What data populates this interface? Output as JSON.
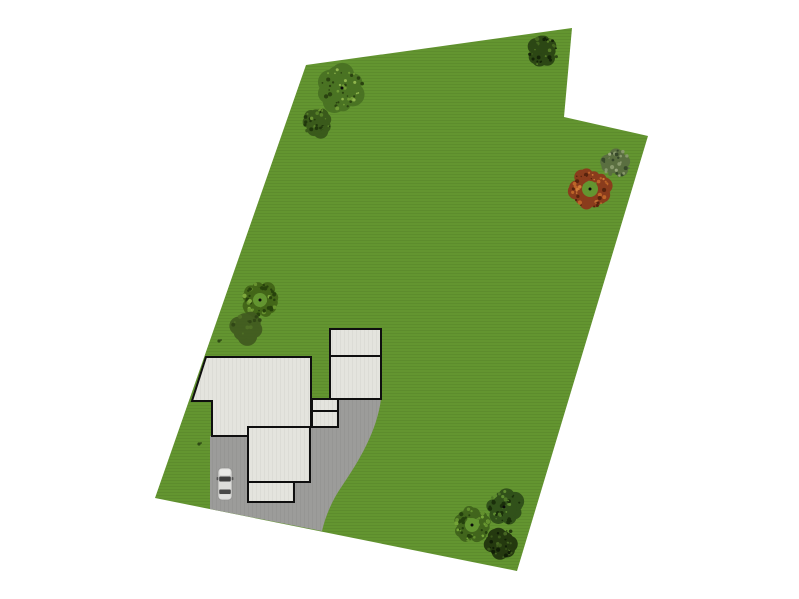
{
  "page": {
    "background": "#ffffff"
  },
  "scene": {
    "canvas": {
      "width": 799,
      "height": 599
    },
    "lot": {
      "name": "property-lot",
      "points": [
        [
          306,
          65
        ],
        [
          572,
          28
        ],
        [
          564,
          117
        ],
        [
          648,
          136
        ],
        [
          517,
          571
        ],
        [
          155,
          498
        ]
      ],
      "fill": "#639530",
      "stripe": "#578529"
    },
    "driveway": {
      "name": "driveway",
      "path": "M 210,436 L 311,427 L 312,399 L 381,399 C 377,431 359,461 342,486 C 333,499 326,514 322,531 L 210,509 Z",
      "fill": "#9c9c9a",
      "stripe": "#929290"
    },
    "house": {
      "fill": "#e4e4de",
      "stripe": "#d9d9d3",
      "stroke": "#0f0f0f",
      "stroke_width": 2,
      "shapes": [
        {
          "name": "main-house",
          "type": "polygon",
          "points": [
            [
              206,
              357
            ],
            [
              311,
              357
            ],
            [
              311,
              427
            ],
            [
              248,
              427
            ],
            [
              248,
              436
            ],
            [
              212,
              436
            ],
            [
              212,
              401
            ],
            [
              192,
              401
            ]
          ]
        },
        {
          "name": "rear-wing",
          "type": "rect",
          "x": 248,
          "y": 427,
          "w": 62,
          "h": 55
        },
        {
          "name": "rear-porch",
          "type": "rect",
          "x": 248,
          "y": 482,
          "w": 46,
          "h": 20
        },
        {
          "name": "breezeway-upper",
          "type": "rect",
          "x": 312,
          "y": 399,
          "w": 26,
          "h": 12
        },
        {
          "name": "breezeway-lower",
          "type": "rect",
          "x": 312,
          "y": 411,
          "w": 26,
          "h": 16
        },
        {
          "name": "garage-upper",
          "type": "rect",
          "x": 330,
          "y": 329,
          "w": 51,
          "h": 27
        },
        {
          "name": "garage-lower",
          "type": "rect",
          "x": 330,
          "y": 356,
          "w": 51,
          "h": 43
        }
      ]
    },
    "car": {
      "name": "parked-car",
      "x": 218,
      "y": 468,
      "w": 14,
      "h": 32,
      "body": "#d6d6d4",
      "outline": "#8a8a88",
      "hood": "#e9e9e7",
      "roof": "#dcdcda",
      "trunk": "#e2e2e0",
      "glass": "#3f3f3f",
      "glass_rear": "#4a4a4a",
      "mirror": "#555555"
    },
    "trees": [
      {
        "name": "large-tree-northwest",
        "type": "clump",
        "cx": 342,
        "cy": 88,
        "r": 23,
        "dot": true,
        "palette": {
          "base": "#4a7323",
          "dark": "#2a4310",
          "light": "#6f9a35",
          "lite": "#8fb54d"
        }
      },
      {
        "name": "bush-northwest",
        "type": "clump",
        "cx": 317,
        "cy": 122,
        "r": 15,
        "dot": false,
        "palette": {
          "base": "#3a5a1b",
          "dark": "#20370c",
          "light": "#567f28",
          "lite": "#6c9433"
        }
      },
      {
        "name": "tree-north",
        "type": "clump",
        "cx": 543,
        "cy": 51,
        "r": 16,
        "dot": false,
        "palette": {
          "base": "#2c4714",
          "dark": "#142408",
          "light": "#45671f",
          "lite": "#557a26"
        }
      },
      {
        "name": "shrub-east",
        "type": "clump",
        "cx": 616,
        "cy": 163,
        "r": 15,
        "dot": false,
        "palette": {
          "base": "#5a6f40",
          "dark": "#36482a",
          "light": "#87986b",
          "lite": "#9aa87e"
        }
      },
      {
        "name": "red-bush-east",
        "type": "ring",
        "cx": 590,
        "cy": 189,
        "r": 20,
        "hole": 8,
        "dot": true,
        "palette": {
          "base": "#8a3c1c",
          "dark": "#57230d",
          "light": "#bd6428",
          "lite": "#d07c38"
        }
      },
      {
        "name": "bush-west",
        "type": "ring",
        "cx": 260,
        "cy": 300,
        "r": 18,
        "hole": 7,
        "dot": true,
        "palette": {
          "base": "#436618",
          "dark": "#27420c",
          "light": "#68932f",
          "lite": "#7da83c"
        }
      },
      {
        "name": "bush-shadow-west",
        "type": "shadow",
        "cx": 247,
        "cy": 327,
        "r": 16,
        "dot": false,
        "palette": {
          "base": "#40591f",
          "dark": "#2c3f14",
          "light": "#4e6b26",
          "lite": "#4e6b26"
        }
      },
      {
        "name": "bush-southeast-a",
        "type": "clump",
        "cx": 504,
        "cy": 507,
        "r": 18,
        "dot": true,
        "palette": {
          "base": "#31511a",
          "dark": "#1a2f0b",
          "light": "#4e7827",
          "lite": "#5e8c30"
        }
      },
      {
        "name": "bush-southeast-b",
        "type": "ring",
        "cx": 472,
        "cy": 525,
        "r": 18,
        "hole": 7,
        "dot": true,
        "palette": {
          "base": "#41651c",
          "dark": "#24400d",
          "light": "#63902e",
          "lite": "#74a437"
        }
      },
      {
        "name": "bush-southeast-c",
        "type": "clump",
        "cx": 502,
        "cy": 543,
        "r": 16,
        "dot": false,
        "palette": {
          "base": "#24390f",
          "dark": "#101d06",
          "light": "#3b581b",
          "lite": "#466622"
        }
      }
    ],
    "markers": {
      "color": "#2e4a14",
      "points": [
        {
          "x": 219,
          "y": 341
        },
        {
          "x": 199,
          "y": 444
        }
      ]
    }
  }
}
